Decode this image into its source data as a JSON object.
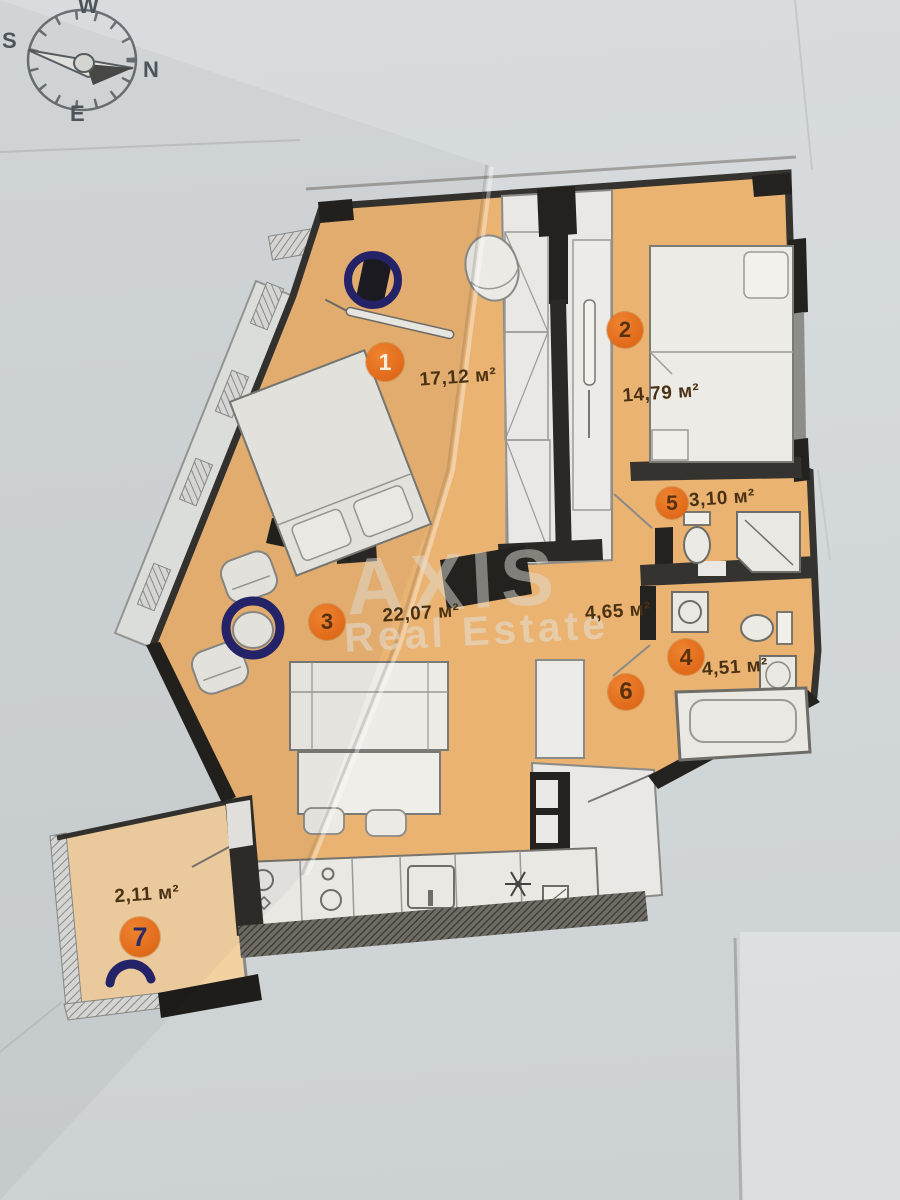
{
  "compass": {
    "w": "W",
    "s": "S",
    "n": "N",
    "e": "E"
  },
  "watermark": {
    "line1": "AXIS",
    "line2": "Real Estate"
  },
  "rooms": [
    {
      "number": "1",
      "area": "17,12 м²"
    },
    {
      "number": "2",
      "area": "14,79 м²"
    },
    {
      "number": "3",
      "area": "22,07 м²"
    },
    {
      "number": "4",
      "area": "4,51 м²"
    },
    {
      "number": "5",
      "area": "3,10 м²"
    },
    {
      "number": "6",
      "area": "4,65 м²"
    },
    {
      "number": "7",
      "area": "2,11 м²"
    }
  ],
  "colors": {
    "paper": "#d5d9db",
    "floor": "#eab371",
    "floor_light": "#f3d2a2",
    "wall": "#35332f",
    "badge": "#e06e1c",
    "marker_ink": "#28286a",
    "label_text": "#4a3114"
  }
}
